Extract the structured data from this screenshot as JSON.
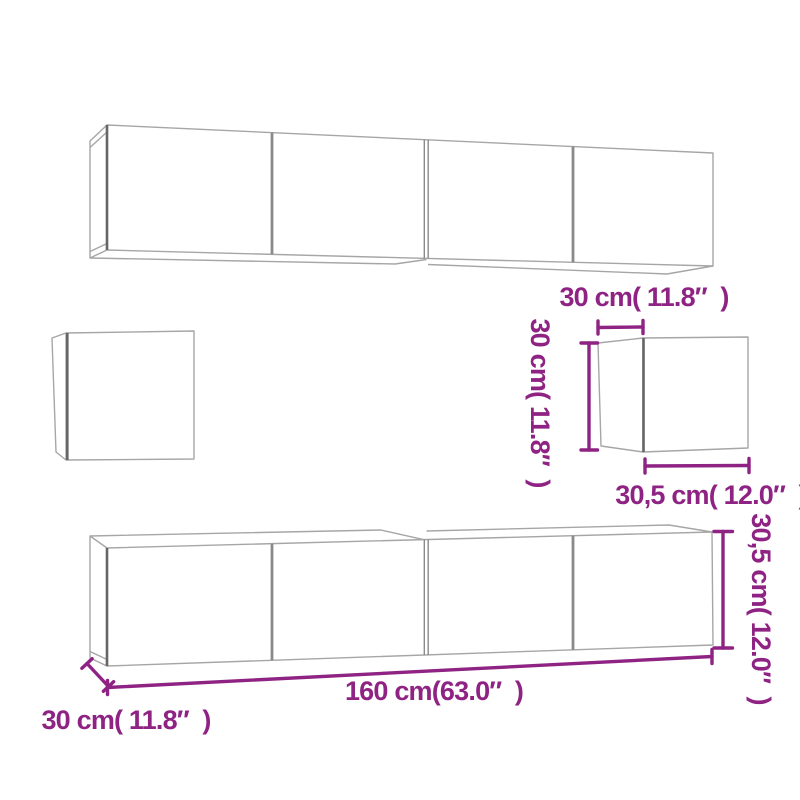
{
  "colors": {
    "background": "#ffffff",
    "dimension_accent": "#8f2384",
    "outline_gray": "#a6a6a6",
    "divider_gray": "#8a8a8a",
    "edge_gray": "#666666"
  },
  "small_wall_cabinet": {
    "depth_label": "30 cm( 11.8″  )",
    "height_label": "30 cm( 11.8″  )",
    "width_label": "30,5 cm( 12.0″  )"
  },
  "tv_stand": {
    "height_label": "30,5 cm( 12.0″  )",
    "width_label": "160 cm(63.0″  )",
    "depth_label": "30 cm( 11.8″  )"
  }
}
